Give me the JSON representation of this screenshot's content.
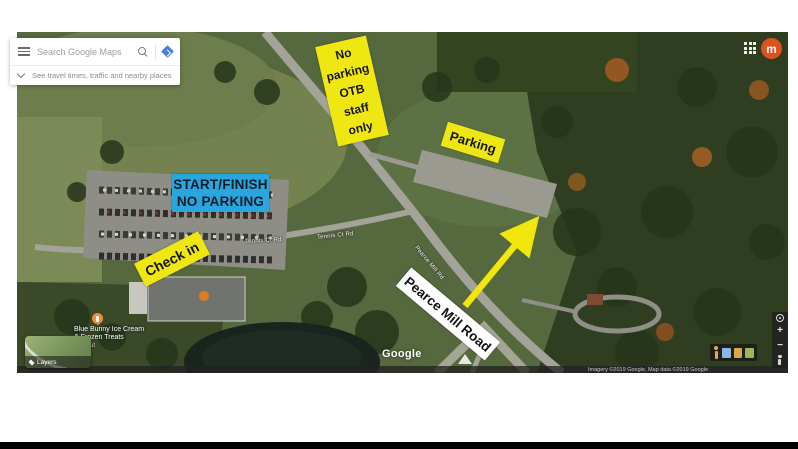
{
  "window": {
    "background": "#ffffff",
    "letterbox_bar_color": "#000000"
  },
  "maps_ui": {
    "search": {
      "placeholder": "Search Google Maps"
    },
    "travel_hint": "See travel times, traffic and nearby places",
    "avatar_letter": "m",
    "avatar_color": "#e0521d",
    "layers_label": "Layers",
    "watermark": "Google",
    "attribution": "Imagery ©2019 Google, Map data ©2019 Google",
    "zoom_in": "+",
    "zoom_out": "−"
  },
  "map_labels": {
    "poi_name_line1": "Blue Bunny Ice Cream",
    "poi_name_line2": "& Frozen Treats",
    "poi_sub": "Takeout",
    "road_label_main": "Pearce Mill Rd",
    "road_label_side_a": "Tennis Ct Rd",
    "road_label_side_b": "Tennis Ct Rd"
  },
  "annotations": {
    "staff_parking": {
      "line1": "No",
      "line2": "parking",
      "line3": "OTB",
      "line4": "staff",
      "line5": "only",
      "bg": "#efe712",
      "text_color": "#151515"
    },
    "parking": {
      "label": "Parking",
      "bg": "#efe712"
    },
    "start_finish": {
      "line1": "START/FINISH",
      "line2": "NO PARKING",
      "bg": "#2aa6de",
      "text_color": "#101c29"
    },
    "check_in": {
      "label": "Check in",
      "bg": "#efe712"
    },
    "road_callout": {
      "label": "Pearce Mill Road",
      "bg": "#ffffff"
    },
    "arrow_color": "#f2e70c"
  }
}
